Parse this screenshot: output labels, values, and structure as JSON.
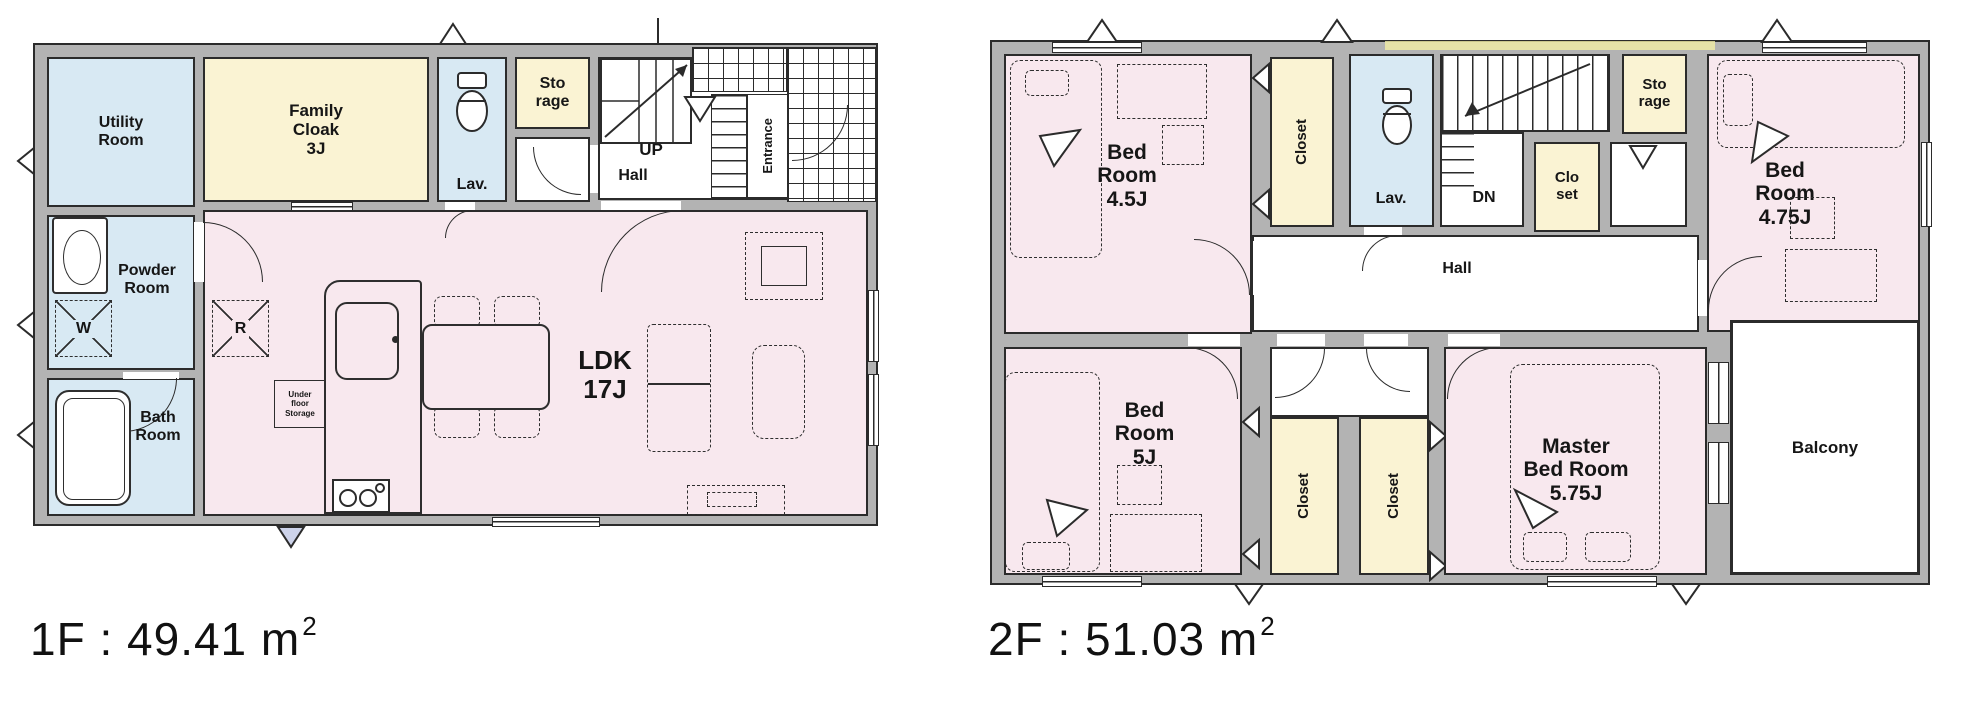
{
  "colors": {
    "pink": "#f8e8ee",
    "blue": "#d8e9f3",
    "yellow": "#faf3d3",
    "wall": "#b3b3b3",
    "line": "#2b2b2b",
    "highlight": "#f3eda5"
  },
  "floor1": {
    "area_label": {
      "prefix": "1F : 49.41 m",
      "sup": "2"
    },
    "rooms": {
      "utility": "Utility\nRoom",
      "powder": "Powder\nRoom",
      "bath": "Bath\nRoom",
      "family_cloak": "Family\nCloak\n3J",
      "lav": "Lav.",
      "storage": "Sto\nrage",
      "up": "UP",
      "hall": "Hall",
      "entrance": "Entrance",
      "ldk": "LDK\n17J",
      "fridge": "R",
      "washer": "W",
      "underfloor_storage": "Under\nfloor\nStorage"
    }
  },
  "floor2": {
    "area_label": {
      "prefix": "2F : 51.03 m",
      "sup": "2"
    },
    "rooms": {
      "bed_45": "Bed\nRoom\n4.5J",
      "closet_north": "Closet",
      "lav": "Lav.",
      "dn": "DN",
      "closet_mid": "Clo\nset",
      "storage": "Sto\nrage",
      "bed_475": "Bed\nRoom\n4.75J",
      "hall": "Hall",
      "bed_5": "Bed\nRoom\n5J",
      "closet_s1": "Closet",
      "closet_s2": "Closet",
      "master": "Master\nBed Room\n5.75J",
      "balcony": "Balcony"
    }
  }
}
